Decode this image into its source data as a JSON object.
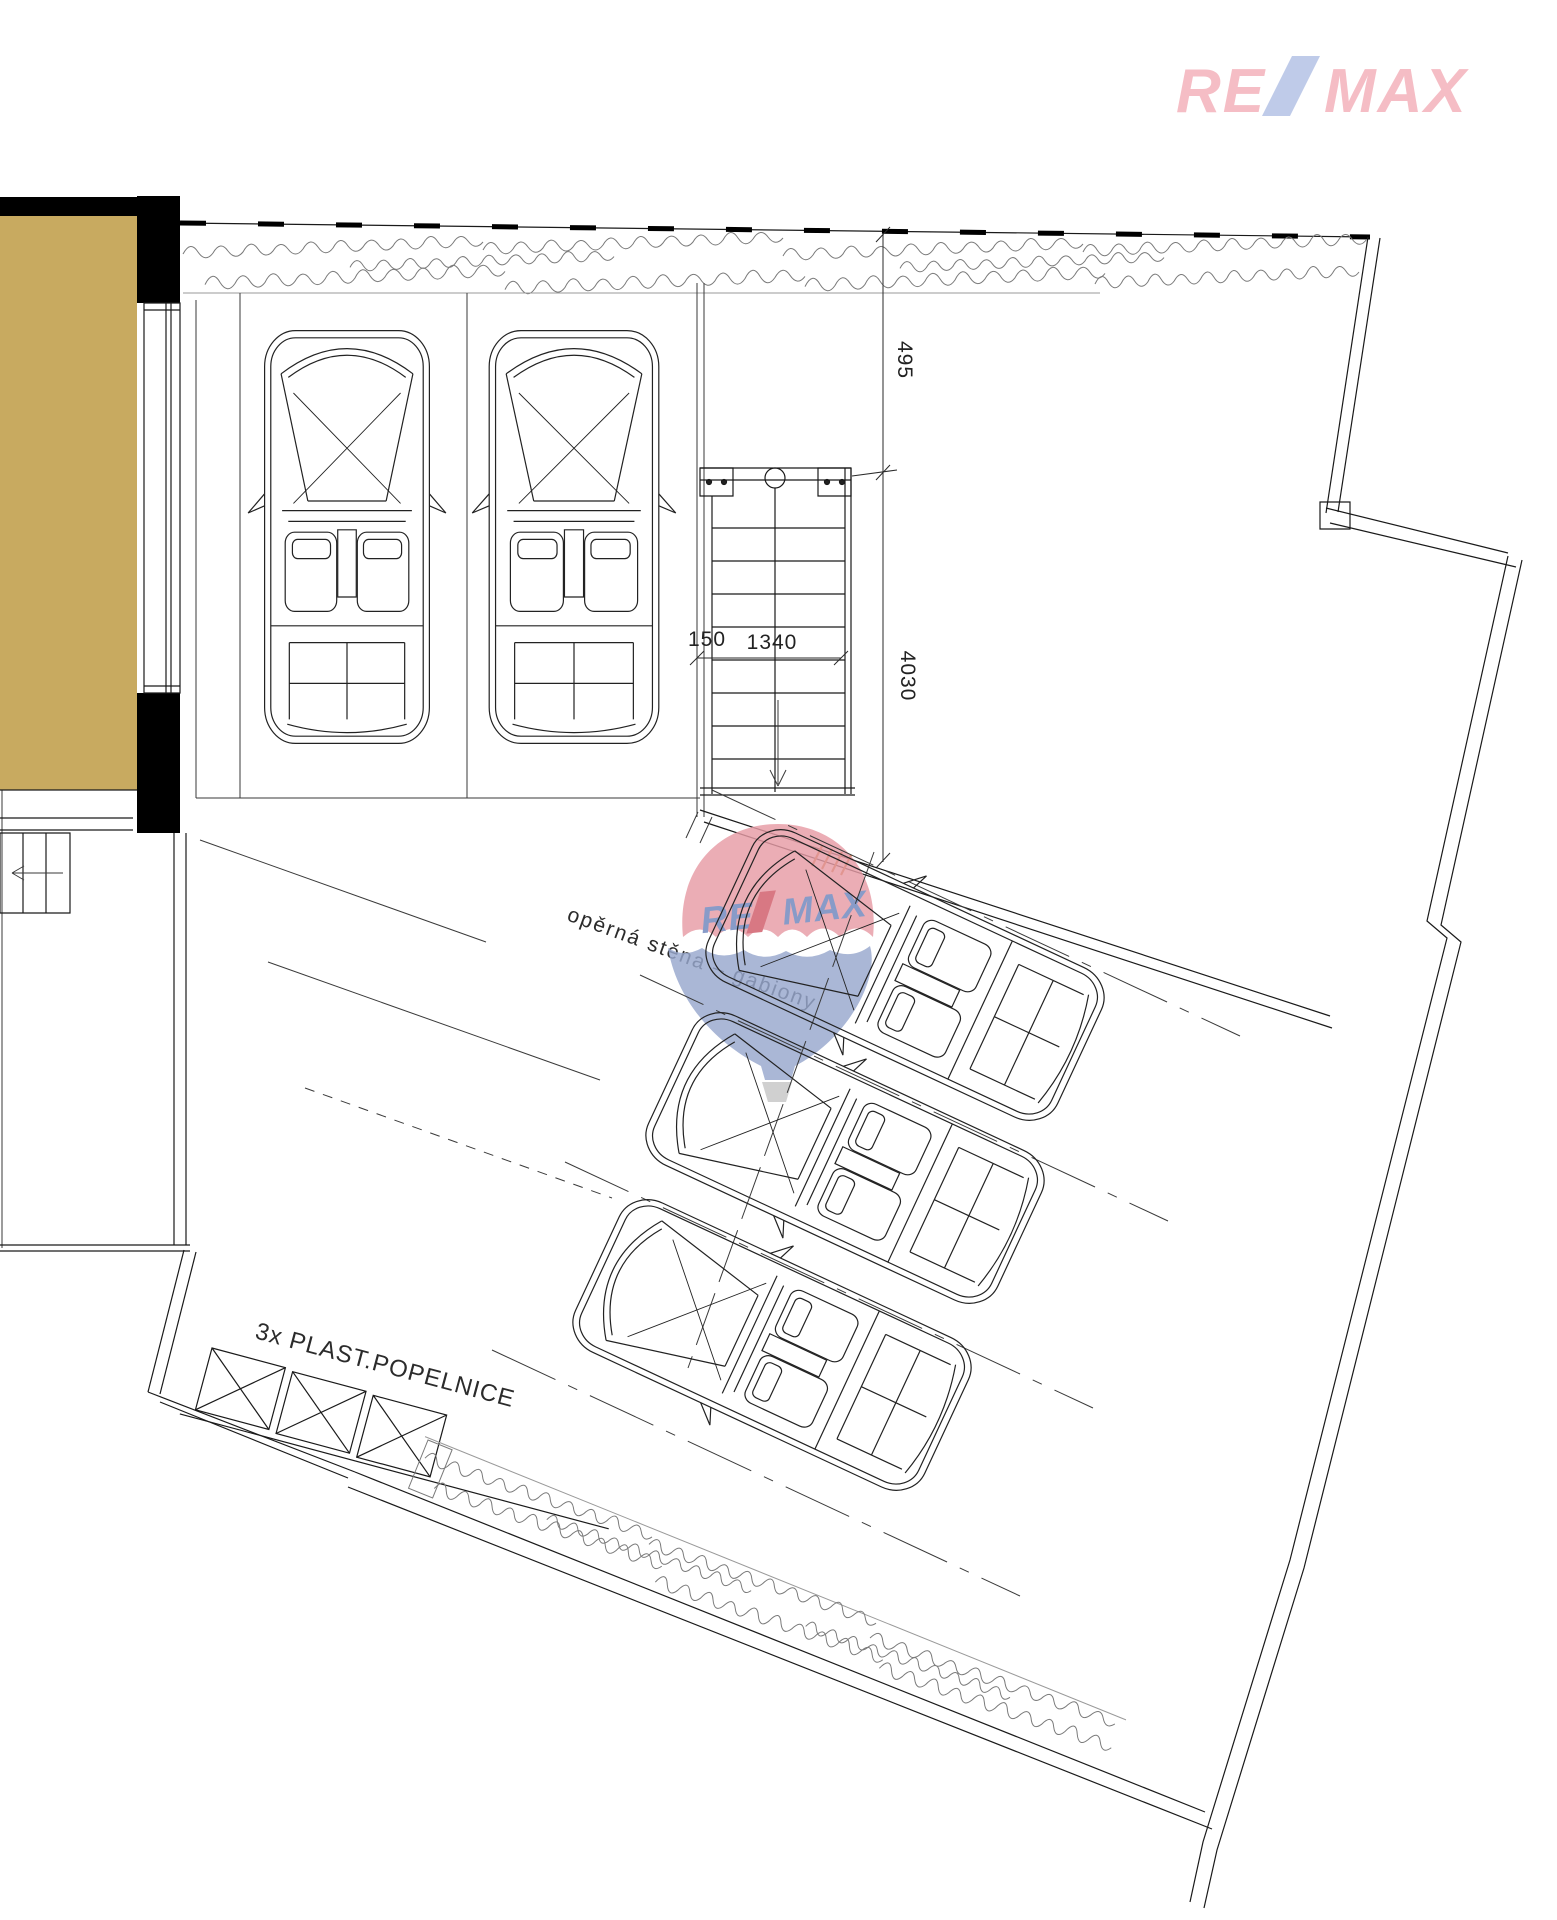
{
  "logo": {
    "re": "RE",
    "slash": "/",
    "max": "MAX"
  },
  "watermark": {
    "re": "RE",
    "slash": "/",
    "max": "MAX"
  },
  "dims": {
    "d495": "495",
    "d4030": "4030",
    "d150": "150",
    "d1340": "1340"
  },
  "labels": {
    "retaining_wall": "opěrná stěna – gabiony",
    "bins": "3x PLAST.POPELNICE"
  },
  "colors": {
    "logo_pink": "#f5bdc5",
    "logo_slash_blue": "#bfcbe9",
    "balloon_red": "#e79ca6",
    "balloon_blue": "#98a8ce",
    "balloon_text_blue": "#6e86bd",
    "balloon_slash_red": "#d05b68",
    "room_fill": "#c8aa60",
    "drawing_line": "#1a1a1a",
    "hedge_line": "#7a7a7a",
    "hatch_orange": "#c8772e"
  }
}
